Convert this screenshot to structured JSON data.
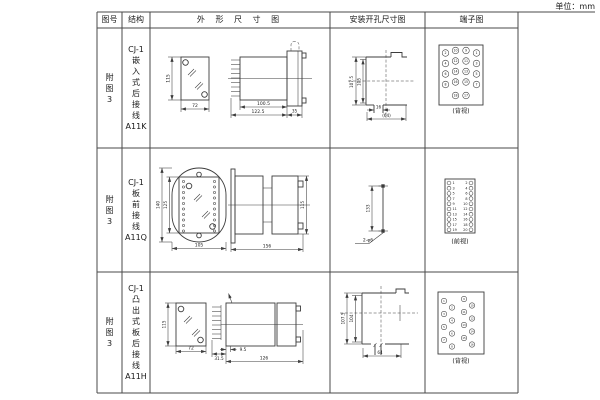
{
  "unit_label": "单位：mm",
  "header": {
    "figure_col": "图号",
    "structure_col": "结构",
    "outline_col": "外 形 尺 寸 图",
    "mounting_col": "安装开孔尺寸图",
    "terminal_col": "端子图"
  },
  "rows": [
    {
      "figure_no": "附\n图\n3",
      "structure": "CJ-1\n嵌\n入\n式\n后\n接\n线\nA11K",
      "outline": {
        "front_height": "115",
        "front_width": "72",
        "body_depth": "100.5",
        "total_depth": "122.5",
        "flange_depth": "35"
      },
      "mounting": {
        "outer_height": "107.5",
        "inner_height": "105",
        "slot_width": "16",
        "overall_width": "(64)"
      },
      "terminal": {
        "view_label": "(背视)",
        "pin_rows": [
          [
            "2",
            "10",
            "9",
            "1"
          ],
          [
            "4",
            "12",
            "11",
            "3"
          ],
          [
            "6",
            "14",
            "13",
            "5"
          ],
          [
            "8",
            "16",
            "15",
            "7"
          ],
          [
            "18",
            "17"
          ]
        ]
      }
    },
    {
      "figure_no": "附\n图\n3",
      "structure": "CJ-1\n板\n前\n接\n线\nA11Q",
      "outline": {
        "flange_height": "140",
        "body_height": "125",
        "front_width": "105",
        "total_depth": "156",
        "side_height": "115"
      },
      "mounting": {
        "hole_spacing": "133",
        "hole_note": "2-φ6"
      },
      "terminal": {
        "view_label": "(前视)",
        "left_numbers": [
          "1",
          "3",
          "5",
          "7",
          "9",
          "11",
          "13",
          "15",
          "17",
          "19"
        ],
        "right_numbers": [
          "2",
          "4",
          "6",
          "8",
          "10",
          "12",
          "14",
          "16",
          "18",
          "20"
        ]
      }
    },
    {
      "figure_no": "附\n图\n3",
      "structure": "CJ-1\n凸\n出\n式\n板\n后\n接\n线\nA11H",
      "outline": {
        "front_height": "115",
        "front_width": "72",
        "pin_depth": "31.5",
        "gap_depth": "9.5",
        "body_depth": "126"
      },
      "mounting": {
        "outer_height": "107.5",
        "inner_height": "104",
        "overall_width": "64"
      },
      "terminal": {
        "view_label": "(背视)",
        "numbers": [
          "1",
          "2",
          "3",
          "4",
          "5",
          "6",
          "7",
          "8",
          "9",
          "10",
          "11",
          "12",
          "13",
          "14",
          "15",
          "16"
        ]
      }
    }
  ]
}
